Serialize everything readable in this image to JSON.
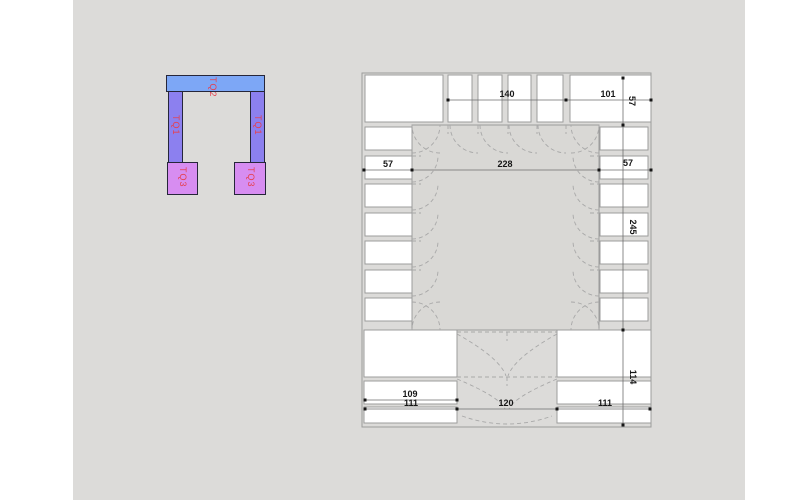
{
  "app": {
    "background_color": "#ffffff",
    "canvas_color": "#dcdbd9"
  },
  "legend": {
    "label_color": "#e5404f",
    "items": [
      {
        "name": "TQ2",
        "color": "#7da7f6"
      },
      {
        "name": "TQ1",
        "color": "#8c80ef"
      },
      {
        "name": "TQ1",
        "color": "#8c80ef"
      },
      {
        "name": "TQ3",
        "color": "#d78df1"
      },
      {
        "name": "TQ3",
        "color": "#d78df1"
      }
    ]
  },
  "plan": {
    "dims": {
      "top_center": "140",
      "top_right": "101",
      "top_height": "57",
      "mid_left": "57",
      "mid_span": "228",
      "mid_right": "57",
      "right_upper": "245",
      "right_lower": "114",
      "bottom_panel": "109",
      "bottom_left": "111",
      "bottom_center": "120",
      "bottom_right": "111"
    }
  }
}
